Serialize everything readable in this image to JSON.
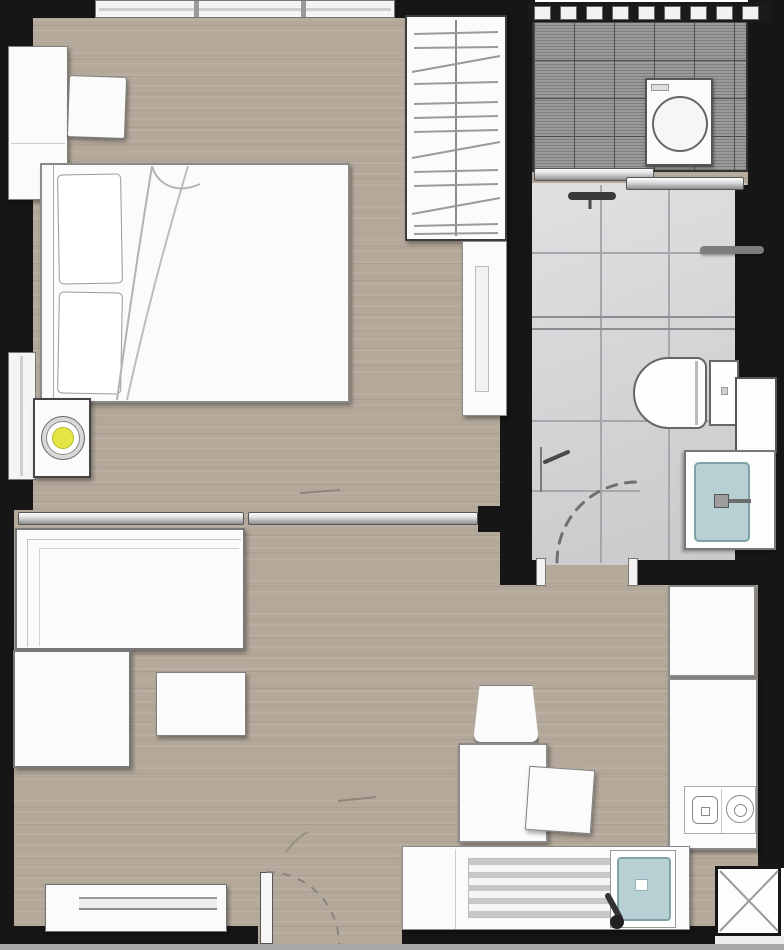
{
  "meta": {
    "title": "one-bedroom-apartment-floor-plan",
    "width_px": 784,
    "height_px": 950,
    "visible_text": "none"
  },
  "palette": {
    "wall": "#161616",
    "wood": "#b3a89a",
    "balcony_tile": "#9a9a9a",
    "balcony_grid": "#4f4f4f",
    "bath_tile": "#d6d6d8",
    "bath_grout": "#a7a7ab",
    "furniture": "#fbfbfb",
    "furniture_border": "#7f7f7f",
    "accent_teal": "#b7d0d3",
    "accent_teal_border": "#7fa3a6",
    "accent_yellow": "#e3e644",
    "outside": "#a9a9a9"
  },
  "rooms": [
    {
      "name": "bedroom",
      "floor": "wood",
      "contents": [
        "window-strip",
        "nightstand",
        "stool",
        "double-bed",
        "pillows",
        "duvet-fold",
        "lamp-table",
        "round-lamp",
        "wardrobe-with-hangers",
        "dresser-cabinet",
        "side-window"
      ]
    },
    {
      "name": "living-area",
      "floor": "wood",
      "contents": [
        "sliding-partition",
        "sofa",
        "ottoman",
        "coffee-table",
        "tv-console",
        "entrance-door",
        "desk-chair",
        "desk",
        "side-table"
      ]
    },
    {
      "name": "kitchen",
      "floor": "wood",
      "contents": [
        "fridge-cabinet",
        "counter-right",
        "two-burner-cooktop",
        "counter-bottom",
        "drainer",
        "kitchen-sink-teal",
        "faucet"
      ]
    },
    {
      "name": "bathroom",
      "floor": "light-gray-tile",
      "contents": [
        "rain-shower-head",
        "shower-mixer",
        "glass-screen",
        "towel-bar",
        "toilet",
        "wall-niche",
        "vanity",
        "basin-teal",
        "door-swing"
      ]
    },
    {
      "name": "balcony-laundry",
      "floor": "dark-gray-tile",
      "contents": [
        "railing",
        "washing-machine",
        "sliding-door"
      ]
    },
    {
      "name": "service-shaft",
      "floor": "none",
      "contents": [
        "cross-marked-shaft-box"
      ]
    }
  ]
}
